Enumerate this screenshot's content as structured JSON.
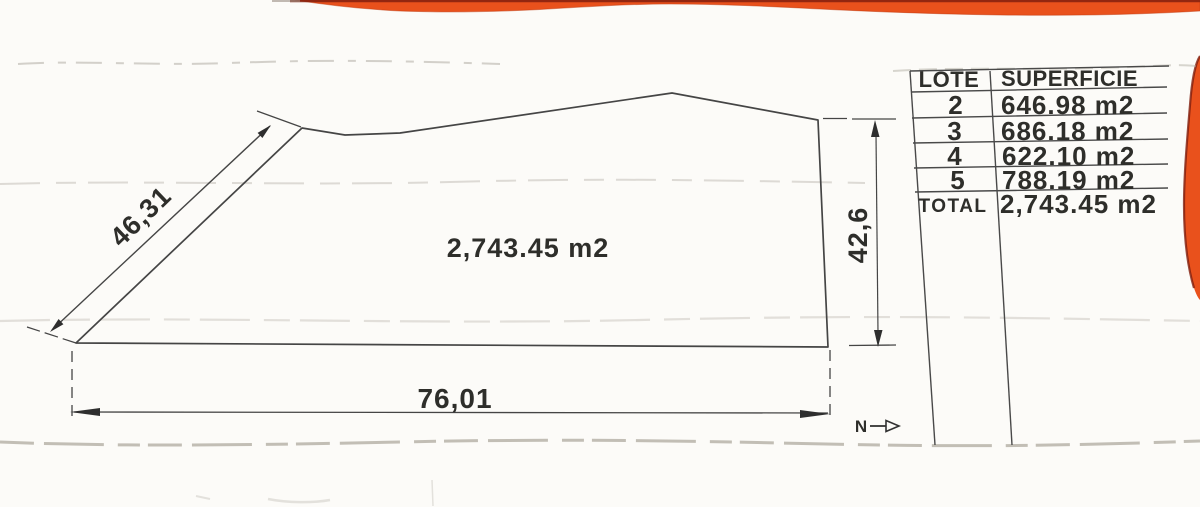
{
  "drawing": {
    "area_label": "2,743.45 m2",
    "dim_left_label": "46,31",
    "dim_right_label": "42,6",
    "dim_bottom_label": "76,01",
    "north_label": "N"
  },
  "lot_table": {
    "header": {
      "lote": "LOTE",
      "superficie": "SUPERFICIE"
    },
    "rows": [
      {
        "lote": "2",
        "superficie": "646.98 m2"
      },
      {
        "lote": "3",
        "superficie": "686.18 m2"
      },
      {
        "lote": "4",
        "superficie": "622.10 m2"
      },
      {
        "lote": "5",
        "superficie": "788.19 m2"
      }
    ],
    "total_label": "TOTAL",
    "total_value": "2,743.45 m2"
  },
  "colors": {
    "paper": "#fcfbf8",
    "ink": "#3a3a3a",
    "scan_stripe": "#e9511c",
    "scan_stripe_dark": "#84200e",
    "artifact_gray": "#aaa69c"
  }
}
